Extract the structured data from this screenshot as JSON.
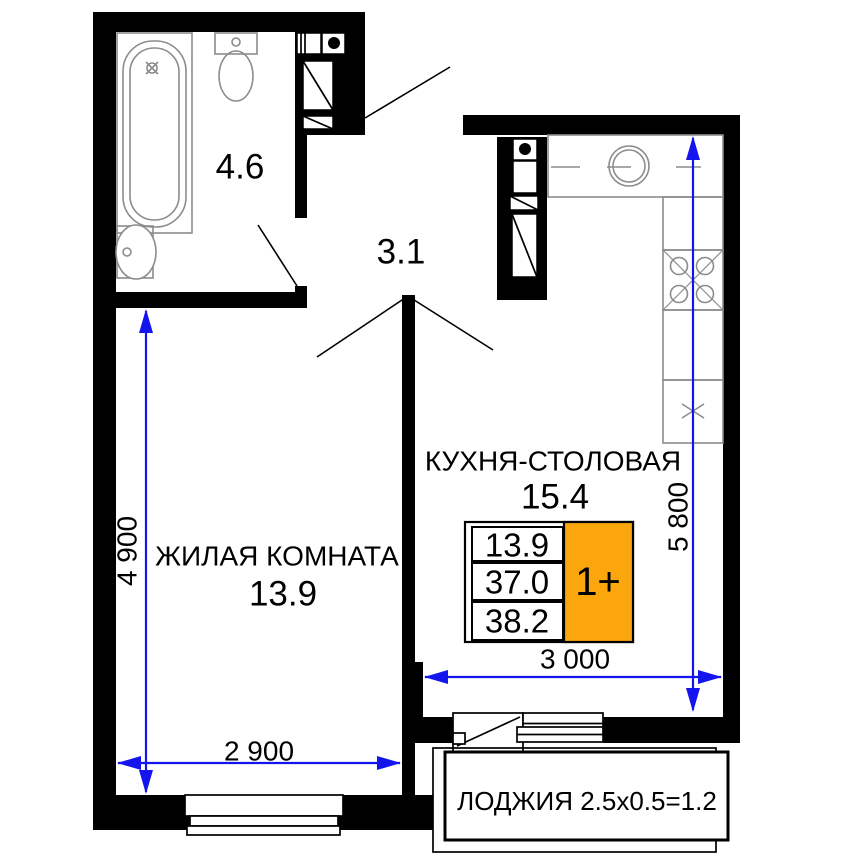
{
  "rooms": {
    "bathroom": {
      "area": "4.6"
    },
    "hallway": {
      "area": "3.1"
    },
    "living_room": {
      "name": "ЖИЛАЯ КОМНАТА",
      "area": "13.9"
    },
    "kitchen_dining": {
      "name": "КУХНЯ-СТОЛОВАЯ",
      "area": "15.4"
    },
    "loggia": {
      "label": "ЛОДЖИЯ 2.5x0.5=1.2"
    }
  },
  "dimensions": {
    "living_height_mm": "4 900",
    "living_width_mm": "2 900",
    "kitchen_height_mm": "5 800",
    "kitchen_width_mm": "3 000"
  },
  "info_table": {
    "living_area": "13.9",
    "apartment_area": "37.0",
    "total_area": "38.2",
    "type": "1+"
  },
  "colors": {
    "dimension": "#1414ee",
    "type_badge": "#FBA60D",
    "wall": "#000000",
    "fixture": "#8c8c8c"
  }
}
